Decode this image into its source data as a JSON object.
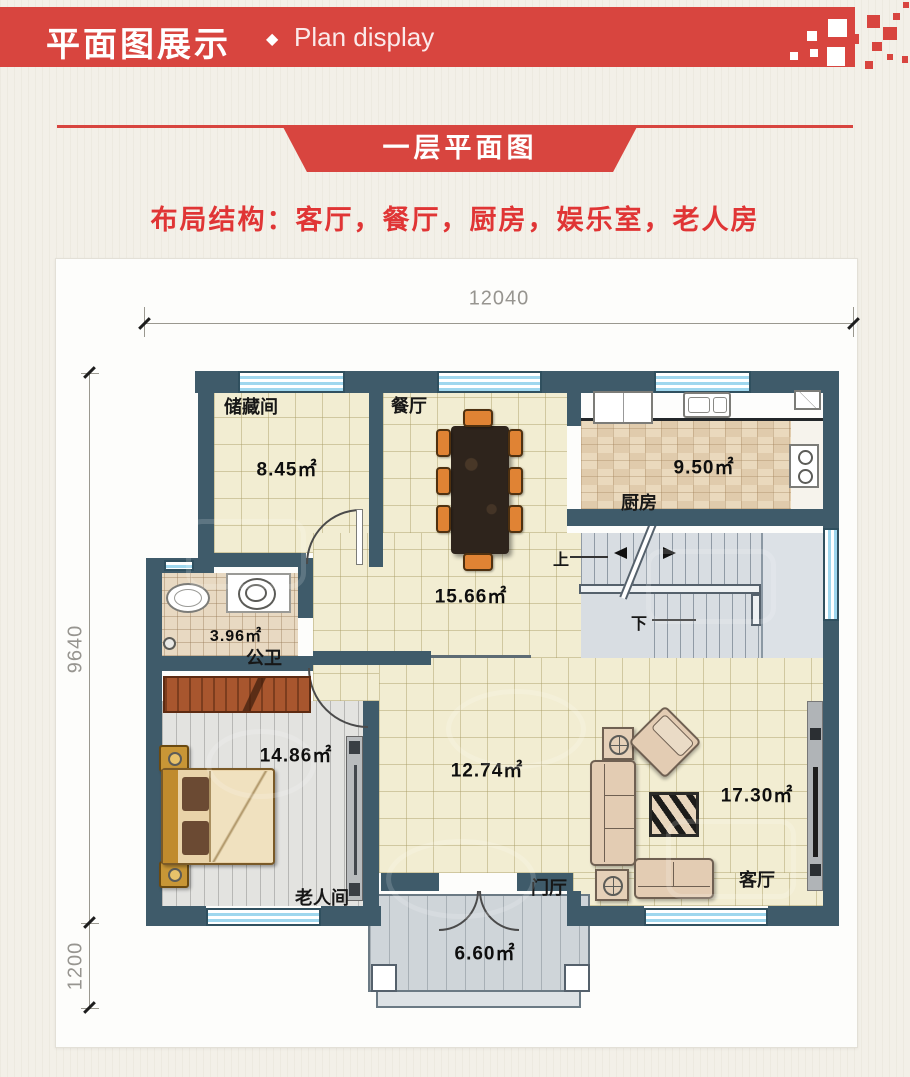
{
  "header": {
    "title_cn": "平面图展示",
    "divider": "◆",
    "title_en": "Plan display"
  },
  "ribbon": {
    "label": "一层平面图"
  },
  "intro": {
    "text": "布局结构：客厅，餐厅，厨房，娱乐室，老人房"
  },
  "dims": {
    "top": "12040",
    "left": "9640",
    "left_lower": "1200"
  },
  "rooms": {
    "storage": {
      "name": "储藏间",
      "area": "8.45㎡"
    },
    "dining": {
      "name": "餐厅",
      "area": "15.66㎡"
    },
    "kitchen": {
      "name": "厨房",
      "area": "9.50㎡"
    },
    "bath": {
      "name": "公卫",
      "area": "3.96㎡"
    },
    "elder": {
      "name": "老人间",
      "area": "14.86㎡"
    },
    "family": {
      "area": "12.74㎡"
    },
    "living": {
      "name": "客厅",
      "area": "17.30㎡"
    },
    "foyer": {
      "name": "门厅",
      "area": "6.60㎡"
    }
  },
  "stairs": {
    "up": "上",
    "down": "下"
  },
  "colors": {
    "accent": "#d8453f",
    "wall": "#3f5b6a",
    "window_blue": "#9fd7ee",
    "floor_cream": "#f2edd2"
  }
}
